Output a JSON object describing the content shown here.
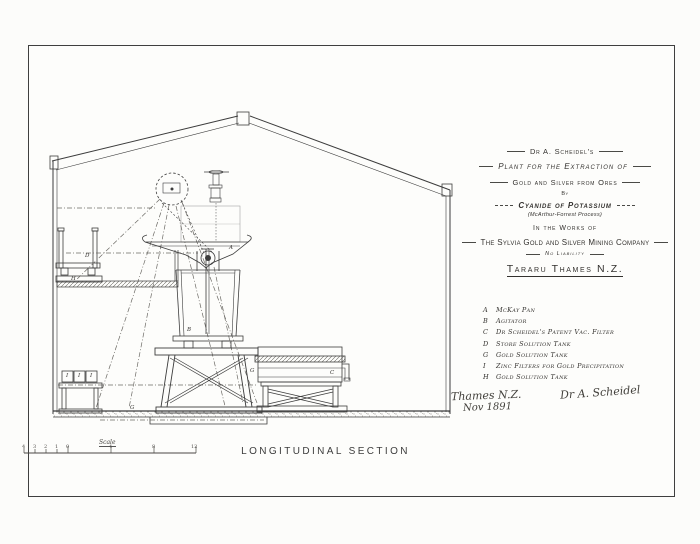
{
  "title_block": {
    "author": "Dr A. Scheidel's",
    "plant": "Plant for the Extraction of",
    "gold_silver": "Gold and Silver from Ores",
    "by": "By",
    "cyanide": "Cyanide of Potassium",
    "process": "(McArthur-Forrest Process)",
    "works": "In the Works of",
    "company": "The Sylvia Gold and Silver Mining Company",
    "no_liability": "No Liability",
    "location": "Tararu Thames N.Z."
  },
  "legend": {
    "items": [
      {
        "letter": "A",
        "label": "McKay Pan"
      },
      {
        "letter": "B",
        "label": "Agitator"
      },
      {
        "letter": "C",
        "label": "Dr Scheidel's Patent Vac. Filter"
      },
      {
        "letter": "D",
        "label": "Store Solution Tank"
      },
      {
        "letter": "G",
        "label": "Gold Solution Tank"
      },
      {
        "letter": "I",
        "label": "Zinc Filters for Gold Precipitation"
      },
      {
        "letter": "H",
        "label": "Gold Solution Tank"
      }
    ]
  },
  "notes": {
    "place": "Thames N.Z.",
    "date": "Nov 1891",
    "signature": "Dr A. Scheidel"
  },
  "caption": "LONGITUDINAL SECTION",
  "scale_bar": {
    "label": "Scale",
    "numbers": [
      "4",
      "3",
      "2",
      "1",
      "0",
      "4",
      "8",
      "12"
    ]
  },
  "drawing_labels": {
    "d": "D",
    "h": "H",
    "a": "A",
    "b": "B",
    "g1": "G",
    "c": "C",
    "g2": "G",
    "i1": "I",
    "i2": "I",
    "i3": "I"
  },
  "colors": {
    "ink": "#3c3c3c",
    "paper": "#fdfdfb",
    "frame": "#3f3f3f"
  }
}
